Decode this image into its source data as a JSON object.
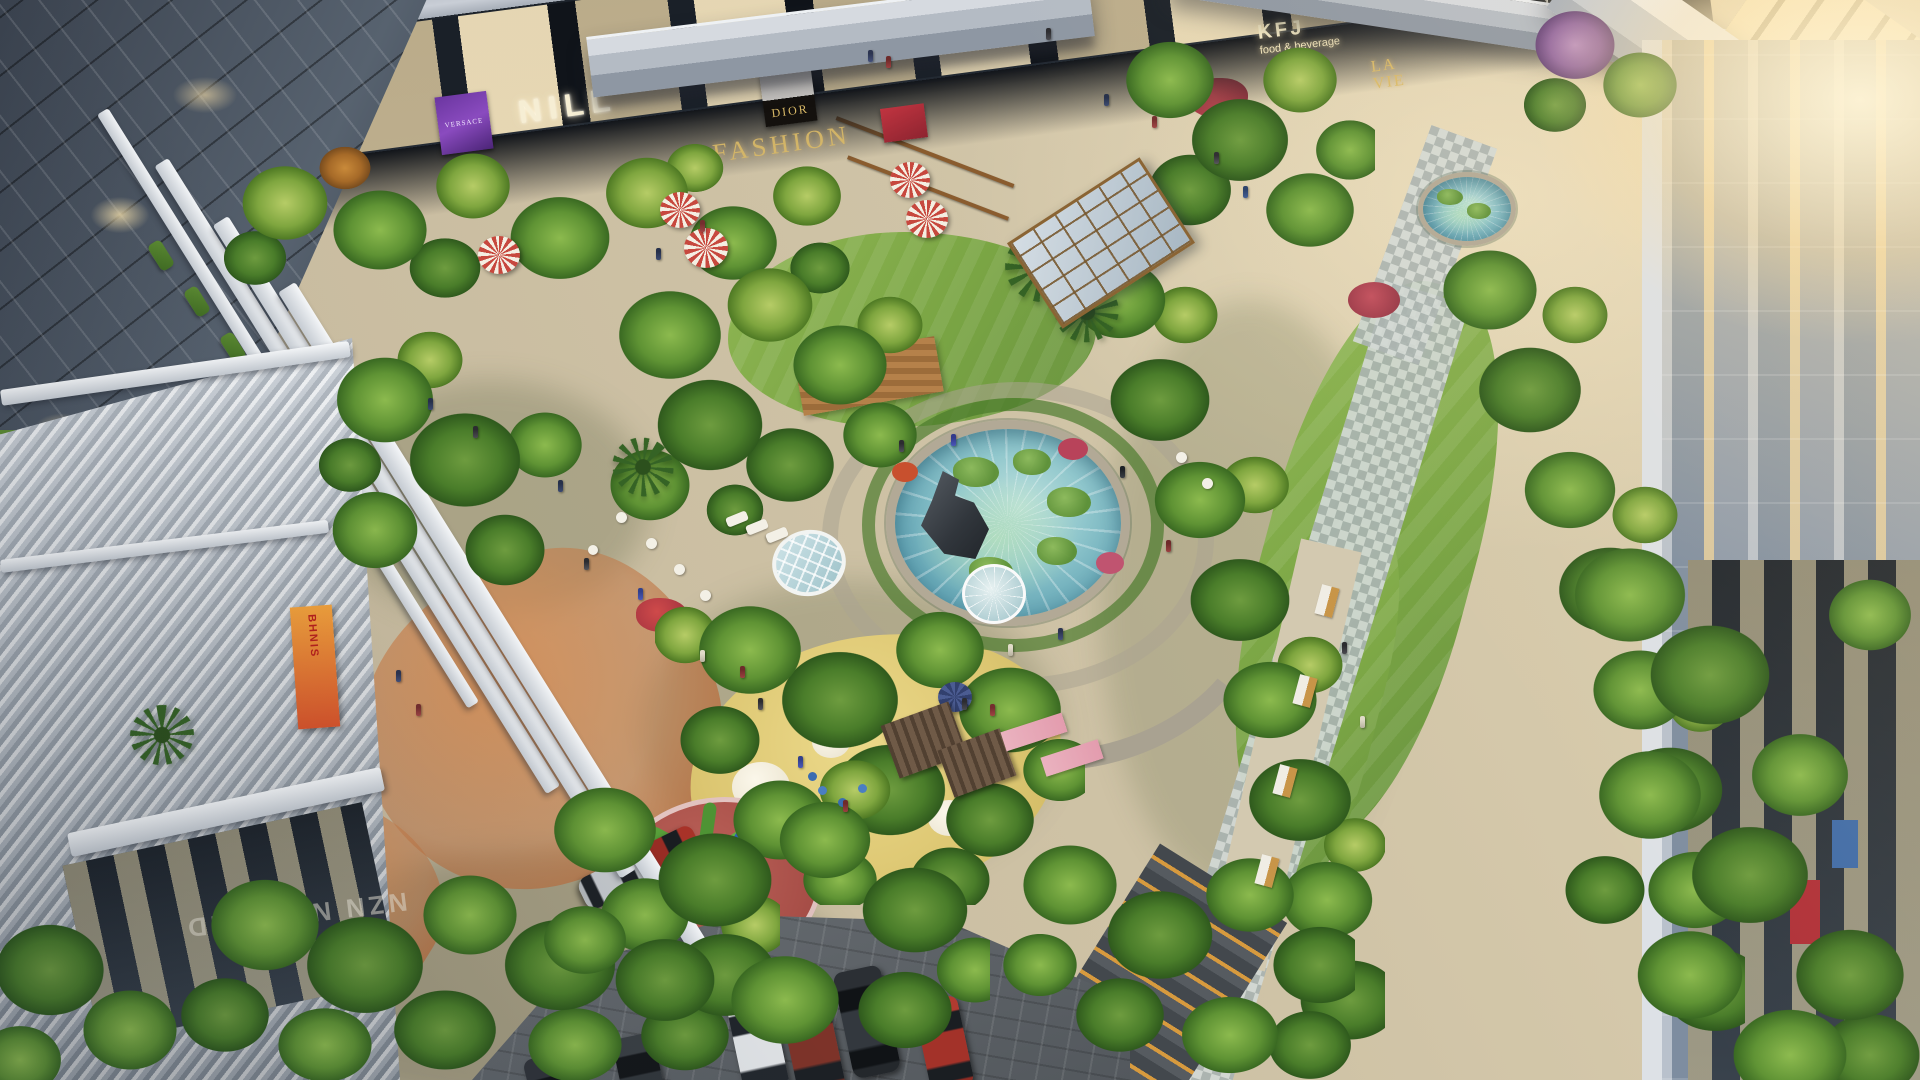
{
  "scene": {
    "description": "Aerial rendering of a mixed-use development: retail towers around a landscaped courtyard with lotus pond, playgrounds and parking",
    "signs": {
      "versace": "VERSACE",
      "nill": "NILL",
      "dior": "DIOR",
      "fashion": "FASHION",
      "kfj": "KFJ",
      "kfj_sub": "food & beverage",
      "love_script": "Lovelelemela",
      "lavie_top": "LA",
      "lavie_bottom": "VIE",
      "floor_text": "NZN NEROIND",
      "banner_text": "BHNIS"
    },
    "palette": {
      "stone_plaza": "#cfc3a6",
      "lawn_green": "#7aa544",
      "tree_dark": "#2f5a1d",
      "tree_mid": "#5f9334",
      "tree_light": "#b6cc66",
      "pond_blue": "#8fc6cc",
      "playground_orange": "#c27542",
      "playground_yellow": "#dcc671",
      "playground_red": "#a84f48",
      "glass_dark": "#242b34",
      "warm_window": "#e9d7aa",
      "slab_white": "#eceef1",
      "sign_gold": "#d9b967",
      "umbrella_red": "#c7483e"
    }
  }
}
